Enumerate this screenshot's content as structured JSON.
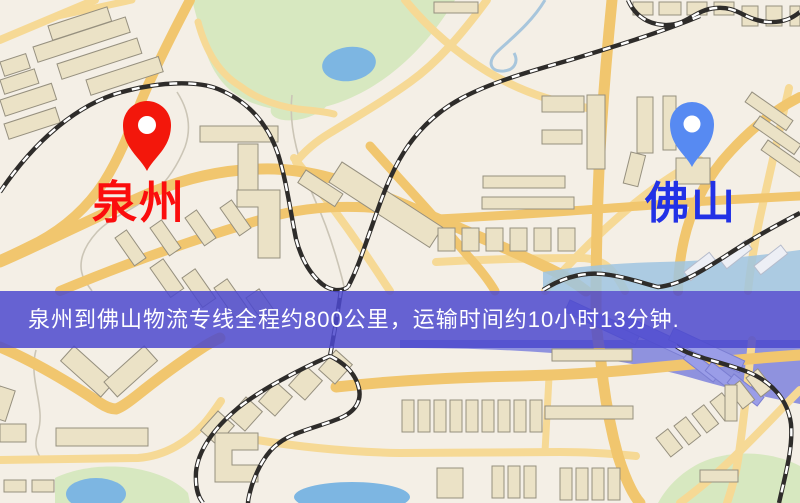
{
  "map": {
    "origin_marker": {
      "name": "origin",
      "label": "泉州",
      "pin_color": "#f3170b",
      "label_color": "#fb0d0d"
    },
    "destination_marker": {
      "name": "destination",
      "label": "佛山",
      "pin_color": "#578af2",
      "label_color": "#2231e6"
    },
    "banner": {
      "text": "泉州到佛山物流专线全程约800公里，运输时间约10小时13分钟.",
      "background_color": "rgba(76,73,206,0.85)",
      "text_color": "#ffffff",
      "distance_km": "800",
      "duration": "10小时13分钟"
    },
    "palette": {
      "map_bg": "#f4efe6",
      "road": "#f1c66e",
      "road_minor": "#f6d995",
      "building": "#ebe2c6",
      "park": "#d7e8c0",
      "water": "#7db6e2",
      "railway": "#2e2c2a",
      "wash": "#8487dd",
      "river_band": "#9fc4e0"
    }
  }
}
